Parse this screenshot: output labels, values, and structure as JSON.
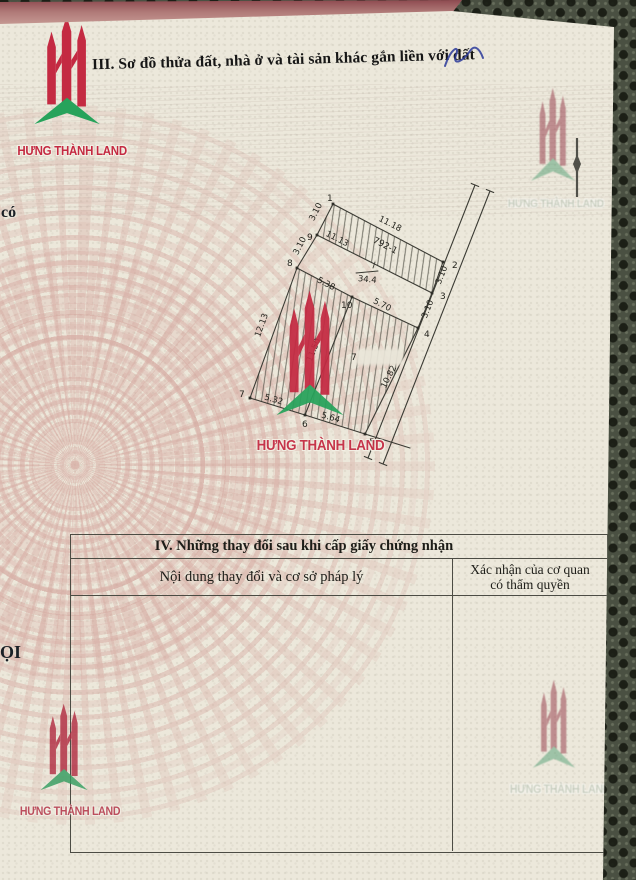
{
  "brand": {
    "name": "HƯNG THÀNH LAND",
    "red": "#c42a42",
    "green": "#27a35b"
  },
  "section3": {
    "title": "III. Sơ đồ thửa đất, nhà ở và tài sản khác gắn liền với đất"
  },
  "edge_text": {
    "left_top": "có",
    "left_bottom": "ỌI"
  },
  "diagram": {
    "parcel_id": "792-1",
    "area_note": "34.4",
    "masked_label": "7",
    "vertices": [
      {
        "id": "1",
        "x": 333,
        "y": 204,
        "lx": 327,
        "ly": 201
      },
      {
        "id": "2",
        "x": 443,
        "y": 262,
        "lx": 452,
        "ly": 268
      },
      {
        "id": "3",
        "x": 432,
        "y": 293,
        "lx": 440,
        "ly": 299
      },
      {
        "id": "4",
        "x": 418,
        "y": 328,
        "lx": 424,
        "ly": 337
      },
      {
        "id": "5",
        "x": 365,
        "y": 434,
        "lx": 369,
        "ly": 445
      },
      {
        "id": "6",
        "x": 305,
        "y": 415,
        "lx": 302,
        "ly": 427
      },
      {
        "id": "7",
        "x": 250,
        "y": 398,
        "lx": 239,
        "ly": 397
      },
      {
        "id": "8",
        "x": 297,
        "y": 268,
        "lx": 287,
        "ly": 266
      },
      {
        "id": "9",
        "x": 317,
        "y": 235,
        "lx": 307,
        "ly": 240
      },
      {
        "id": "10",
        "x": 352,
        "y": 297,
        "lx": 341,
        "ly": 308
      }
    ],
    "edges": [
      [
        "1",
        "2"
      ],
      [
        "2",
        "3"
      ],
      [
        "3",
        "4"
      ],
      [
        "4",
        "5"
      ],
      [
        "5",
        "6"
      ],
      [
        "6",
        "7"
      ],
      [
        "7",
        "8"
      ],
      [
        "8",
        "9"
      ],
      [
        "9",
        "1"
      ],
      [
        "9",
        "3"
      ],
      [
        "8",
        "10"
      ],
      [
        "10",
        "4"
      ],
      [
        "10",
        "6"
      ]
    ],
    "hatched_regions": [
      [
        "1",
        "2",
        "3",
        "9"
      ],
      [
        "8",
        "10",
        "4",
        "5",
        "6",
        "7"
      ]
    ],
    "road": {
      "a": [
        [
          475,
          185
        ],
        [
          368,
          458
        ]
      ],
      "b": [
        [
          490,
          191
        ],
        [
          383,
          464
        ]
      ]
    },
    "extension": [
      [
        365,
        434
      ],
      [
        410,
        448
      ]
    ],
    "labels": [
      {
        "t": "11.18",
        "x": 389,
        "y": 226,
        "r": 27
      },
      {
        "t": "792-1",
        "x": 384,
        "y": 248,
        "r": 27,
        "s": 9
      },
      {
        "t": "11.13",
        "x": 336,
        "y": 241,
        "r": 27
      },
      {
        "t": "3.10",
        "x": 318,
        "y": 213,
        "r": -63
      },
      {
        "t": "3.10",
        "x": 302,
        "y": 247,
        "r": -63
      },
      {
        "t": "3.10",
        "x": 444,
        "y": 276,
        "r": -68
      },
      {
        "t": "3.10",
        "x": 430,
        "y": 310,
        "r": -68
      },
      {
        "t": "12.13",
        "x": 264,
        "y": 326,
        "r": -70
      },
      {
        "t": "5.38",
        "x": 325,
        "y": 286,
        "r": 27
      },
      {
        "t": "5.70",
        "x": 381,
        "y": 307,
        "r": 27
      },
      {
        "t": "34.4",
        "x": 367,
        "y": 282,
        "r": 6,
        "o": 1
      },
      {
        "t": "11.50",
        "x": 316,
        "y": 351,
        "r": -68
      },
      {
        "t": "10.82",
        "x": 391,
        "y": 378,
        "r": -63
      },
      {
        "t": "5.32",
        "x": 273,
        "y": 402,
        "r": 16
      },
      {
        "t": "5.64",
        "x": 330,
        "y": 420,
        "r": 16
      }
    ]
  },
  "table4": {
    "title": "IV. Những thay đổi sau khi cấp giấy chứng nhận",
    "col_left": "Nội dung thay đổi và cơ sở pháp lý",
    "col_right_line1": "Xác nhận của cơ quan",
    "col_right_line2": "có thẩm quyền"
  }
}
